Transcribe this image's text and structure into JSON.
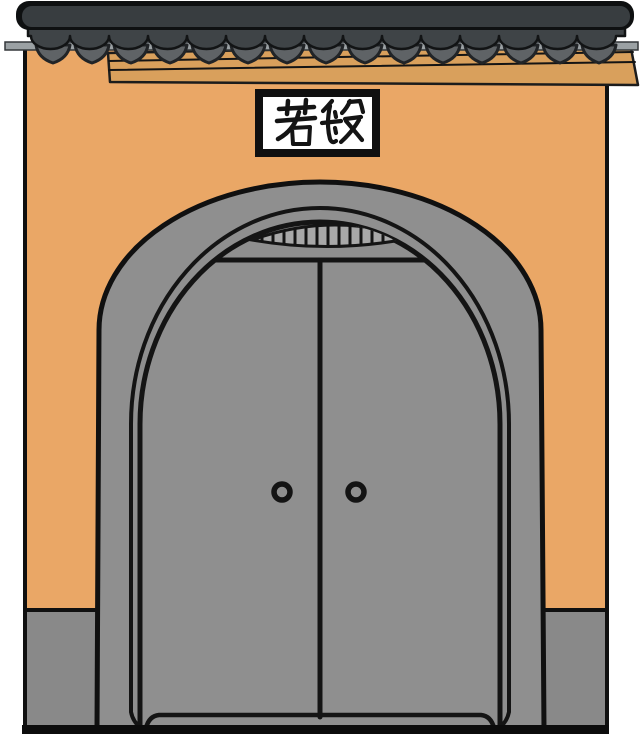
{
  "illustration": {
    "plaque": {
      "text": "若般",
      "characters": [
        "若",
        "般"
      ]
    },
    "roof": {
      "round_tile_count": 15,
      "drip_tile_count": 15
    },
    "door": {
      "leaf_count": 2,
      "knob_count": 2,
      "grille_bar_count": 14
    },
    "colors": {
      "background": "#ffffff",
      "wall": "#eaa766",
      "beam": "#d9a05c",
      "beam_line": "#1c1c1c",
      "ridge_cap": "#0e1011",
      "ridge": "#383d40",
      "tile_band": "#3f4447",
      "drip_tile": "#5f6366",
      "eave_strip": "#9ba1a4",
      "door": "#8f8f8f",
      "base": "#898989",
      "grille": "#a8a8a8",
      "plaque_frame": "#101010",
      "plaque_bg": "#ffffff",
      "ink": "#141414",
      "ground": "#0c0c0c"
    }
  }
}
